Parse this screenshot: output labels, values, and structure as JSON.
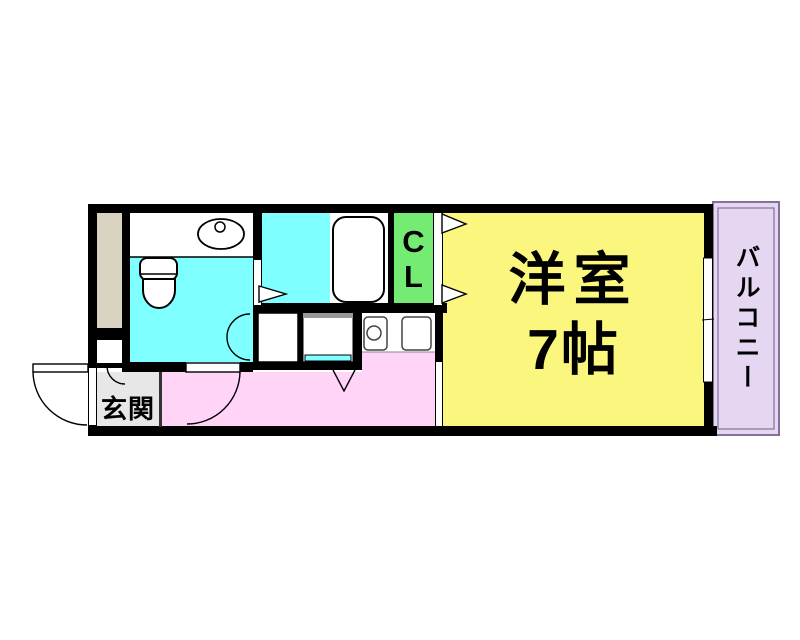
{
  "rooms": {
    "western_room": {
      "name_line1": "洋室",
      "name_line2": "7帖"
    },
    "entrance": {
      "name": "玄関"
    },
    "closet": {
      "name": "CL"
    },
    "balcony": {
      "name": "バルコニー"
    }
  },
  "colors": {
    "wall": "#000000",
    "western_room": "#FBF67D",
    "water_area": "#7FFFFF",
    "hallway": "#FFD4F6",
    "closet": "#74EC74",
    "balcony": "#E5D6F2",
    "balcony_border": "#84709B",
    "entrance": "#E7E7E7",
    "pipe_space": "#D9D2C1",
    "fixture_line": "#444444"
  },
  "fixtures": [
    "toilet",
    "wash-basin",
    "bathtub",
    "kitchen-burner",
    "kitchen-sink",
    "washing-machine-space",
    "closet-door-arrows",
    "door-swing-arcs",
    "window"
  ]
}
